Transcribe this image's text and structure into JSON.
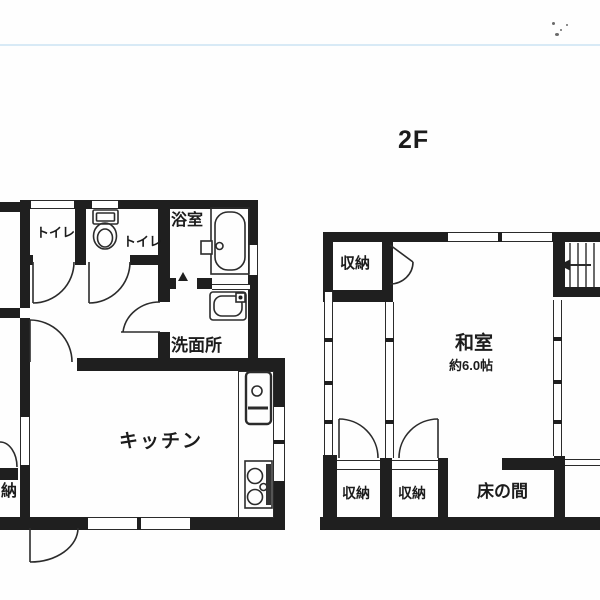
{
  "page": {
    "floor_header": "2F",
    "background_color": "#fefefe",
    "wall_color": "#1f1f1f",
    "line_color": "#2b2b2b",
    "scan_line_color": "#d8eaf6"
  },
  "floor1": {
    "toilet1_label": "トイレ",
    "toilet2_label": "トイレ",
    "bath_label": "浴室",
    "washroom_label": "洗面所",
    "kitchen_label": "キッチン",
    "closet_partial_label": "納"
  },
  "floor2": {
    "closet_top_label": "収納",
    "closet_bottom_left_label": "収納",
    "closet_bottom_right_label": "収納",
    "tatami_room_label": "和室",
    "tatami_size_label": "約6.0帖",
    "alcove_label": "床の間"
  },
  "icons": {
    "toilet": "toilet-plan-symbol",
    "bathtub": "bathtub-plan-symbol",
    "washbasin": "washbasin-plan-symbol",
    "kitchen_sink": "kitchen-sink-plan-symbol",
    "stove": "two-burner-stove-plan-symbol",
    "stairs": "staircase-with-left-arrow",
    "doors": "quarter-circle-door-swing-arcs",
    "closet_door": "hinged-closet-door-symbol"
  }
}
